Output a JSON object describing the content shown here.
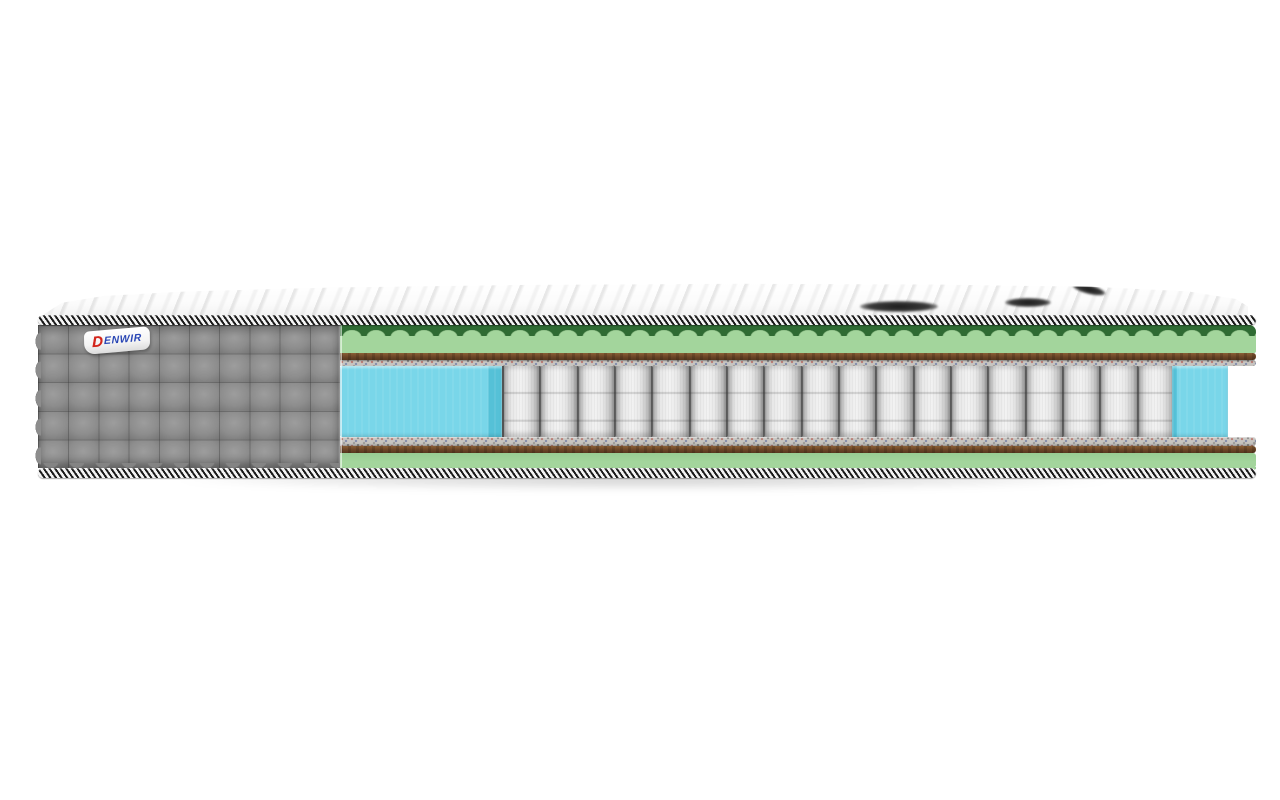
{
  "scene": {
    "background_color": "#ffffff",
    "subject": "mattress-cross-section-photo"
  },
  "mattress": {
    "brand_label": {
      "initial": "D",
      "rest": "ENWIR"
    },
    "spring_count": 18,
    "quilt": {
      "rows": 5,
      "columns": 10
    },
    "colors": {
      "fabric_gray": "#8d8d8d",
      "foam_green": "#a3d59c",
      "foam_green_dark": "#2f6b33",
      "coir_brown": "#6b4527",
      "felt_gray": "#c7c5c1",
      "spring_white": "#ececec",
      "edge_foam_blue": "#79d6e9",
      "edge_foam_blue_dark": "#55c1d7",
      "piping_dark": "#1a1a1a",
      "piping_light": "#f4f4f4",
      "label_red": "#d3261c",
      "label_blue": "#2a47b5"
    }
  }
}
